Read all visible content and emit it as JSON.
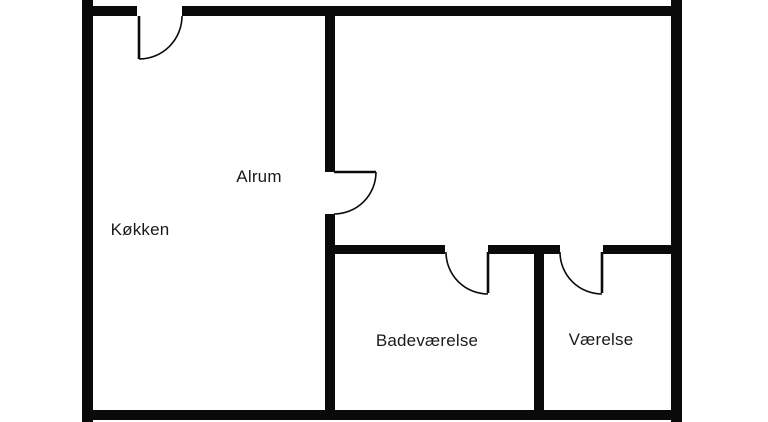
{
  "colors": {
    "wall": "#0a0a0a",
    "background": "#ffffff",
    "text": "#1a1a1a"
  },
  "rooms": [
    {
      "id": "koekken",
      "label": "Køkken"
    },
    {
      "id": "alrum",
      "label": "Alrum"
    },
    {
      "id": "badevaerelse",
      "label": "Badeværelse"
    },
    {
      "id": "vaerelse",
      "label": "Værelse"
    }
  ]
}
